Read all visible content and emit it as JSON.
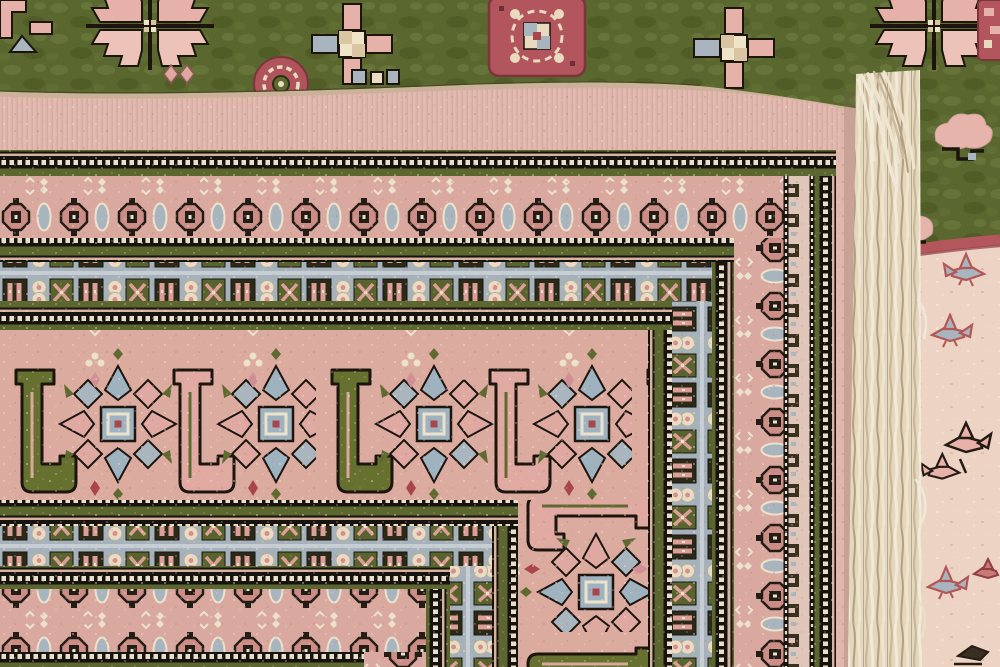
{
  "scene": {
    "description": "Close-up photograph of a handwoven Bokhara-style wool rug folded over to show its pale pink back with nested geometric border bands; the olive-green knotted front pile with pink guls is visible along the top, a white warp fringe runs down the right side, and the cream pile end-border of the rug beneath shows small bird motifs at far right.",
    "type": "photograph",
    "subject": "folded-oriental-rug-back"
  },
  "palette": {
    "backBase": "#ddb2a9",
    "plainBand": "#e0b7ad",
    "bandPink": "#d9a89e",
    "mainPink": "#dcab9f",
    "olive": "#5c672f",
    "oliveDark": "#2b2a19",
    "outline": "#1b150e",
    "greyBlue": "#a6b2bb",
    "cream": "#ece2cc",
    "greenField": "#5a682f",
    "redMedallion": "#b2555c",
    "redAccent": "#a8464b",
    "pinkMotif": "#e6b1a9",
    "fringe": "#f0e8d6",
    "creamPile": "#ecd3c4",
    "foldBeige": "#cbb19a"
  },
  "rug_back": {
    "bands": [
      {
        "name": "plain-outer",
        "pattern": "plain",
        "h": [
          90,
          150,
          872
        ],
        "v": [
          836,
          872
        ]
      },
      {
        "name": "guard-1",
        "pattern": "guard",
        "h": [
          150,
          176,
          836
        ],
        "v": [
          812,
          836
        ]
      },
      {
        "name": "s-motif-strip",
        "pattern": "sstrip",
        "v": [
          786,
          812
        ],
        "vy0": 176
      },
      {
        "name": "rosette-outer",
        "pattern": "rosette",
        "h": [
          176,
          238,
          786
        ],
        "v": [
          734,
          786
        ]
      },
      {
        "name": "guard-2",
        "pattern": "guard",
        "h": [
          238,
          262,
          734
        ],
        "v": [
          712,
          734
        ]
      },
      {
        "name": "bluegrey-outer",
        "pattern": "bluegrey",
        "h": [
          262,
          301,
          712
        ],
        "v": [
          672,
          712
        ]
      },
      {
        "name": "guard-3",
        "pattern": "guard",
        "h": [
          301,
          330,
          672
        ],
        "v": [
          648,
          672
        ]
      },
      {
        "name": "main-border",
        "pattern": "main",
        "h": [
          330,
          500,
          648
        ],
        "v": [
          518,
          648
        ]
      },
      {
        "name": "guard-4",
        "pattern": "guard",
        "h": [
          500,
          526,
          518
        ],
        "v": [
          492,
          518
        ]
      },
      {
        "name": "bluegrey-inner",
        "pattern": "bluegrey",
        "h": [
          526,
          566,
          492
        ],
        "v": [
          450,
          492
        ]
      },
      {
        "name": "guard-5",
        "pattern": "guard",
        "h": [
          566,
          589,
          450
        ],
        "v": [
          426,
          450
        ]
      },
      {
        "name": "rosette-inner",
        "pattern": "rosette",
        "h": [
          589,
          652,
          426
        ],
        "v": [
          364,
          426
        ]
      },
      {
        "name": "guard-6",
        "pattern": "guard",
        "h": [
          652,
          667,
          364
        ]
      }
    ]
  },
  "front_top_strip": {
    "motifs": [
      {
        "type": "pink-hook-partial",
        "cx": 28,
        "cy": 30
      },
      {
        "type": "quartered-gul",
        "cx": 150,
        "cy": 26
      },
      {
        "type": "small-diamonds",
        "cx": 178,
        "cy": 74
      },
      {
        "type": "red-rosette",
        "cx": 281,
        "cy": 84
      },
      {
        "type": "cross-motif",
        "cx": 352,
        "cy": 44
      },
      {
        "type": "grey-squares",
        "cx": 374,
        "cy": 78
      },
      {
        "type": "red-medallion",
        "cx": 537,
        "cy": 36
      },
      {
        "type": "cross-motif",
        "cx": 734,
        "cy": 48
      }
    ]
  },
  "right_panel": {
    "motifs": [
      {
        "type": "quartered-gul",
        "cx": 934,
        "cy": 26
      },
      {
        "type": "red-sliver",
        "cx": 992,
        "cy": 30
      },
      {
        "type": "pink-cloud",
        "cx": 962,
        "cy": 135
      },
      {
        "type": "pink-cloud",
        "cx": 906,
        "cy": 228,
        "flip": true
      },
      {
        "type": "bird-grey",
        "cx": 968,
        "cy": 272,
        "flip": true
      },
      {
        "type": "bird-grey",
        "cx": 948,
        "cy": 333
      },
      {
        "type": "bird-pink",
        "cx": 956,
        "cy": 455
      },
      {
        "type": "bird-grey",
        "cx": 944,
        "cy": 585
      },
      {
        "type": "bird-red",
        "cx": 986,
        "cy": 572
      },
      {
        "type": "bird-dark-partial",
        "cx": 972,
        "cy": 650
      }
    ]
  },
  "fringe": {
    "side": "right",
    "color": "#f0e8d6"
  }
}
